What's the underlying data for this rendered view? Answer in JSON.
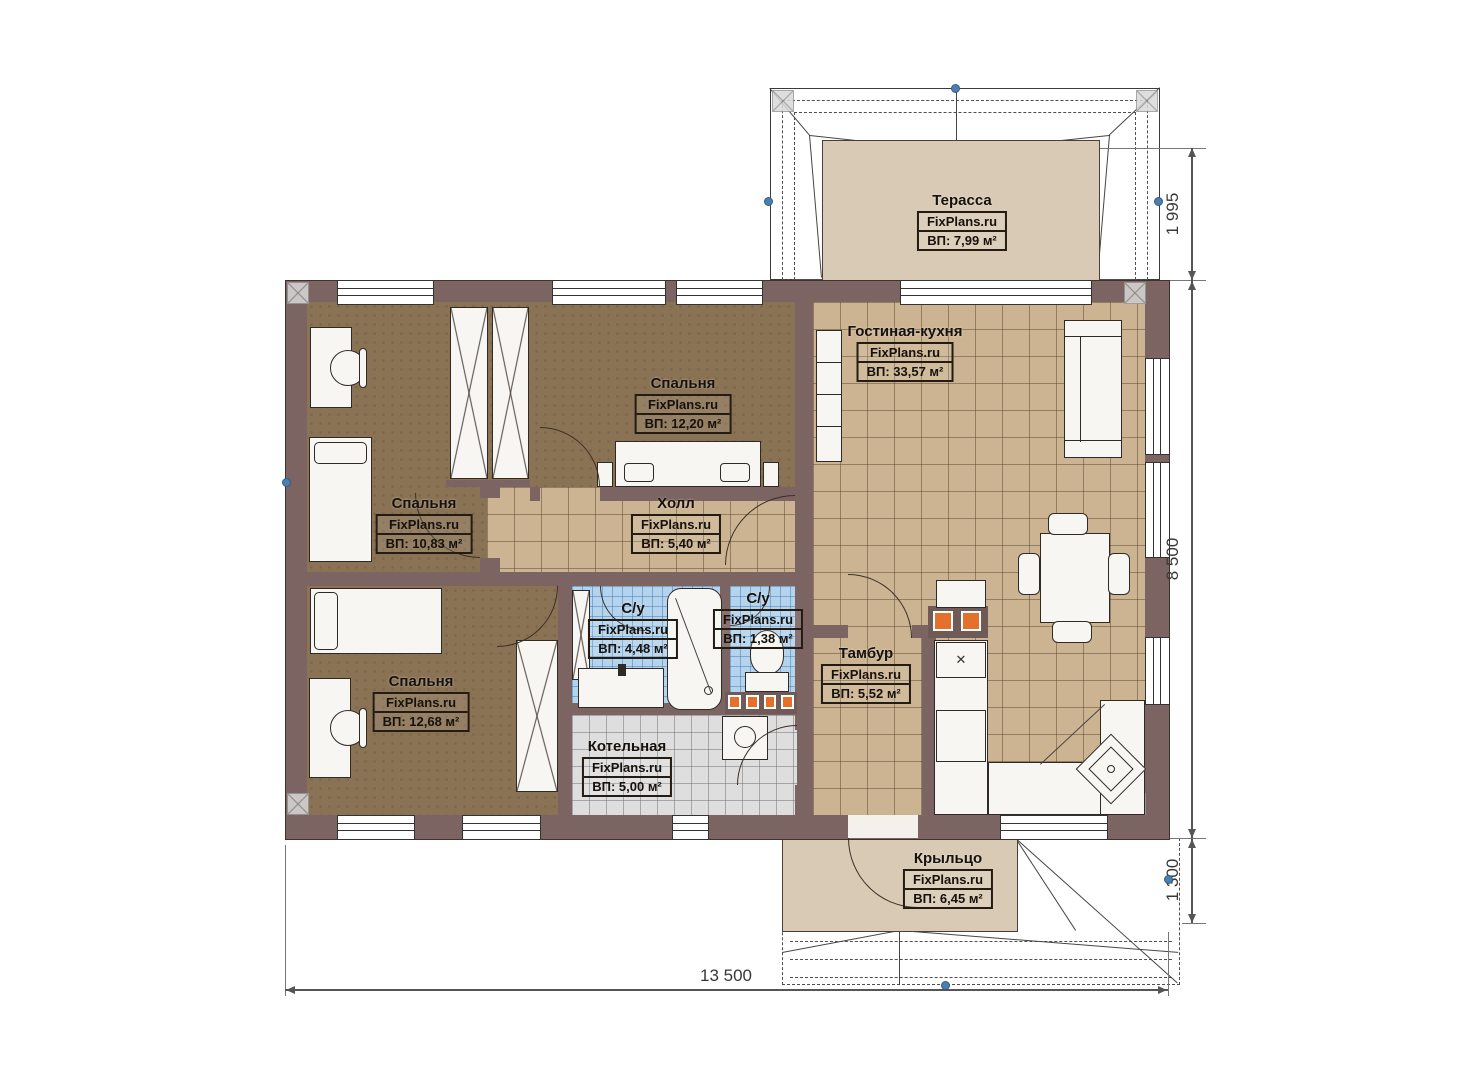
{
  "plan": {
    "watermark": "FixPlans.ru"
  },
  "rooms": {
    "terrace": {
      "name": "Терасса",
      "brand": "FixPlans.ru",
      "area": "ВП: 7,99 м²"
    },
    "living": {
      "name": "Гостиная-кухня",
      "brand": "FixPlans.ru",
      "area": "ВП: 33,57 м²"
    },
    "bedroom_top": {
      "name": "Спальня",
      "brand": "FixPlans.ru",
      "area": "ВП: 12,20 м²"
    },
    "bedroom_left": {
      "name": "Спальня",
      "brand": "FixPlans.ru",
      "area": "ВП: 10,83 м²"
    },
    "hall": {
      "name": "Холл",
      "brand": "FixPlans.ru",
      "area": "ВП: 5,40 м²"
    },
    "bath_big": {
      "name": "С/у",
      "brand": "FixPlans.ru",
      "area": "ВП: 4,48 м²"
    },
    "bath_small": {
      "name": "С/у",
      "brand": "FixPlans.ru",
      "area": "ВП: 1,38 м²"
    },
    "tambour": {
      "name": "Тамбур",
      "brand": "FixPlans.ru",
      "area": "ВП: 5,52 м²"
    },
    "bedroom_bottom": {
      "name": "Спальня",
      "brand": "FixPlans.ru",
      "area": "ВП: 12,68 м²"
    },
    "boiler": {
      "name": "Котельная",
      "brand": "FixPlans.ru",
      "area": "ВП: 5,00 м²"
    },
    "porch": {
      "name": "Крыльцо",
      "brand": "FixPlans.ru",
      "area": "ВП: 6,45 м²"
    }
  },
  "dimensions": {
    "terrace_depth": "1 995",
    "house_depth": "8 500",
    "porch_depth": "1 300",
    "house_width": "13 500"
  },
  "colors": {
    "wall": "#7b6462",
    "bedroom_floor": "#8a7254",
    "tile_floor": "#ccb492",
    "bath_tile": "#b4d4ee",
    "boiler_tile": "#dedede",
    "deck_floor": "#d8cab5",
    "radiator": "#e4702c",
    "snap_dot": "#4d7fae"
  }
}
